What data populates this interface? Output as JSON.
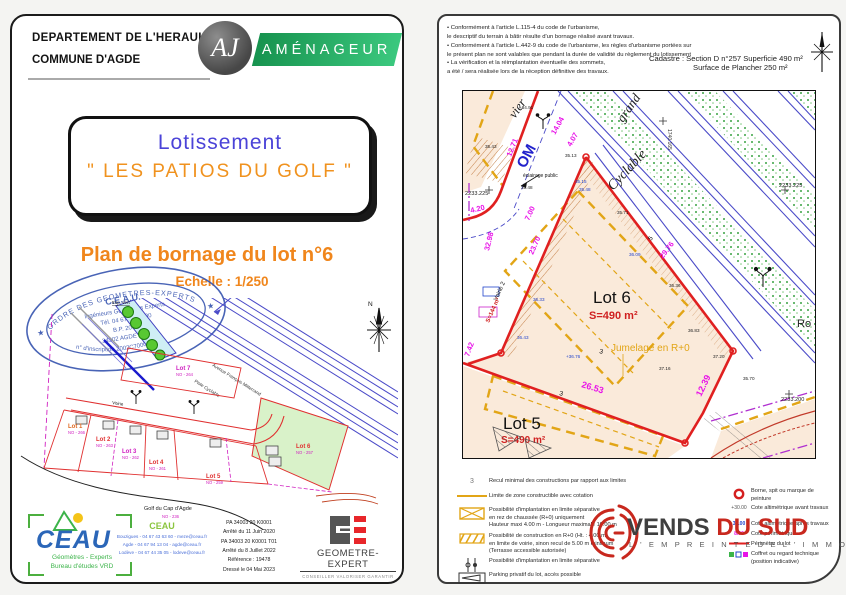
{
  "colors": {
    "accent_orange": "#F0861C",
    "title_blue": "#4B43D8",
    "badge_green": "#2BB673",
    "dim_magenta": "#E812E8",
    "boundary_red": "#E02020",
    "road_blue": "#4A4AC8",
    "zone_orange": "#E2A516",
    "stamp_blue": "#3A57B0",
    "vends_red": "#C8281E"
  },
  "left_page": {
    "header": {
      "department": "DEPARTEMENT DE L'HERAULT",
      "commune": "COMMUNE D'AGDE",
      "logo_initials": "AJ",
      "badge": "AMÉNAGEUR"
    },
    "title_box": {
      "line1": "Lotissement",
      "line2": "\" LES PATIOS DU GOLF \""
    },
    "subtitle": "Plan de bornage du lot n°6",
    "scale": "Echelle : 1/250",
    "stamp": {
      "arc_top": "ORDRE DES GEOMETRES-EXPERTS",
      "name": "C.E.A.U.",
      "line1": "Ingénieurs Géomètres Experts",
      "line2": "Tél. 04 67 94 13 00",
      "line3": "B.P. 20645",
      "line4": "34302 AGDE Cedex",
      "arc_bottom": "n° d'inscription 2002C700001"
    },
    "overview_plan": {
      "street1": "Avenue François Mitterrand",
      "street2": "Piste Cyclable",
      "esp_vert": "Esp. vert",
      "north": "N",
      "voirie": "Voirie",
      "golf": "Golf du Cap d'Agde",
      "golf_parcel": "NO - 236",
      "lots": [
        {
          "label": "Lot 1",
          "parcel": "NO - 266"
        },
        {
          "label": "Lot 2",
          "parcel": "NO - 263"
        },
        {
          "label": "Lot 3",
          "parcel": "NO - 262"
        },
        {
          "label": "Lot 4",
          "parcel": "NO - 261"
        },
        {
          "label": "Lot 5",
          "parcel": "NO - 259"
        },
        {
          "label": "Lot 6",
          "parcel": "NO - 257"
        },
        {
          "label": "Lot 7",
          "parcel": "NO - 264"
        }
      ]
    },
    "footer": {
      "ceau_logo_text": "CEAU",
      "ceau_sub1": "Géomètres - Experts",
      "ceau_sub2": "Bureau d'études VRD",
      "office_name": "CEAU",
      "contact1": "Bouzigues - 04 67 43 63 60 - meze@ceau.fr",
      "contact2": "Agde - 04 67 94 13 04 - agde@ceau.fr",
      "contact3": "Lodève - 04 67 44 35 05 - lodeve@ceau.fr",
      "pa1": "PA 34003 20 K0001",
      "pa2": "Arrêté du 11 Juin 2020",
      "pa3": "PA 34003 20 K0001 T01",
      "pa4": "Arrêté du 8 Juillet 2022",
      "reference": "Référence : 19478",
      "date": "Dressé le 04 Mai 2023",
      "ge_title": "GEOMETRE-EXPERT",
      "ge_sub": "CONSEILLER VALORISER GARANTIR"
    }
  },
  "right_page": {
    "notes": [
      "• Conformément à l'article L.115-4 du code de l'urbanisme,",
      "le descriptif du terrain à bâtir résulte d'un bornage réalisé avant travaux.",
      "• Conformément à l'article L.442-9 du code de l'urbanisme, les règles d'urbanisme portées sur",
      "le présent plan ne sont valables que pendant la durée de validité du règlement du lotissement",
      "• La vérification et la réimplantation éventuelle des sommets,",
      "a été / sera réalisée lors de la réception définitive des travaux."
    ],
    "cadastre": {
      "label": "Cadastre",
      "value1": ": Section D  n°257   Superficie  490 m²",
      "value2": "Surface de Plancher 250 m²"
    },
    "plan": {
      "street_fragment1": "vier",
      "street_fragment2": "grand",
      "cyclable": "Cyclable",
      "om": "OM",
      "ro": "Ro",
      "eclairage": "éclairage public",
      "grid_top": "1740.165",
      "lot6_name": "Lot 6",
      "lot6_area": "S=490 m²",
      "lot5_name": "Lot 5",
      "lot5_area": "S=490 m²",
      "jumelage": "Jumelage en R+0",
      "voirie2": "Voirie 2",
      "s144": "S=144 m²",
      "dims": [
        "12.71",
        "14.04",
        "4.07",
        "4.20",
        "7.00",
        "32.98",
        "23.70",
        "7.42",
        "29.76",
        "26.53",
        "12.39"
      ],
      "elevations": [
        "+34.91",
        "35.13",
        "35.15",
        "35.48",
        "35.43",
        "35.71",
        "36.09",
        "36.36",
        "+36.76",
        "36.83",
        "37.20",
        "37.16",
        "35.70",
        "36.33",
        "36.43",
        "35.48"
      ],
      "grid_labels": [
        "2233.225",
        "2233.225",
        "2233.200"
      ],
      "recul_labels": [
        "5",
        "3",
        "3"
      ]
    },
    "legend_badge": "3",
    "legend_left": [
      {
        "l1": "Recul minimal des constructions par rapport aux limites"
      },
      {
        "l1": "Limite de zone constructible avec cotation"
      },
      {
        "l1": "Possibilité d'implantation en  limite séparative",
        "l2": "en rez de chaussée (R+0) uniquement",
        "l3": "Hauteur maxi 4.00 m - Longueur maximale 10.00 m"
      },
      {
        "l1": "Possibilité de construction en R+0 (Ht. : 4.00 m)",
        "l2": "en  limite de voirie, sinon recul de 5.00 m minimum",
        "l3": "(Terrasse accessible autorisée)"
      },
      {
        "l1": "Possibilité d'implantation en  limite séparative"
      },
      {
        "l1": "Parking privatif du lot, accès possible"
      }
    ],
    "legend_right": [
      {
        "sym": "",
        "l1": "Borne, spit ou marque de peinture"
      },
      {
        "sym": "+30.00",
        "l1": "Cote altimétrique avant travaux"
      },
      {
        "sym": "30.00",
        "l1": "Cote altimétrique après travaux"
      },
      {
        "sym": "8.00",
        "l1": "Cote périmétrique"
      },
      {
        "sym": "",
        "l1": "Périmètre du lot"
      },
      {
        "sym": "",
        "l1": "Coffret ou regard technique",
        "l2": "(position indicative)"
      }
    ],
    "vends": {
      "word1": "VENDS ",
      "word2": "DU SUD",
      "tagline": "L ' E M P R E I N T E   D E   L ' I M M O B I L I E R"
    }
  }
}
